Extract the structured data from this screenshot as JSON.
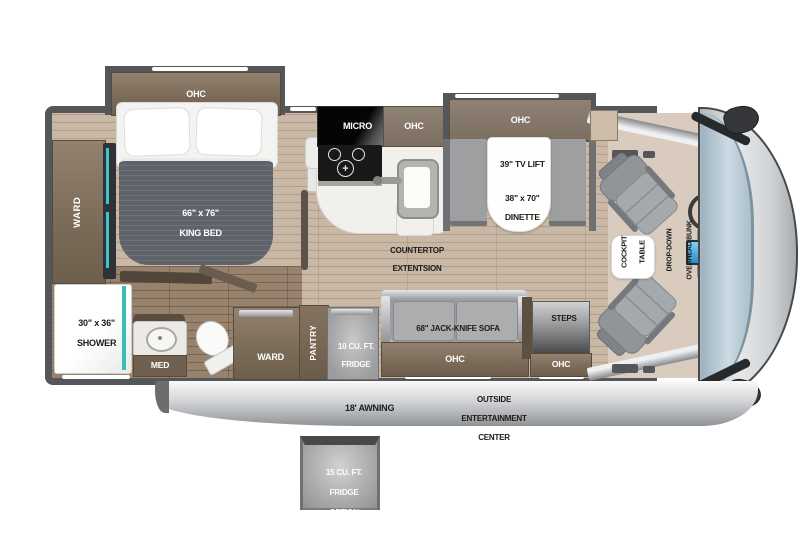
{
  "labels": {
    "bedroom_ohc": "OHC",
    "king_bed_size": "66\" x 76\"",
    "king_bed_name": "KING BED",
    "ward_bedroom": "WARD",
    "tv_option": "TV OPTION",
    "shower_size": "30\" x 36\"",
    "shower_name": "SHOWER",
    "med": "MED",
    "micro": "MICRO",
    "kitchen_ohc": "OHC",
    "countertop_l1": "COUNTERTOP",
    "countertop_l2": "EXTENTSION",
    "dinette_ohc": "OHC",
    "tv_lift": "39\" TV LIFT",
    "dinette_size": "38\" x 70\"",
    "dinette_name": "DINETTE",
    "sofa": "68\" JACK-KNIFE SOFA",
    "sofa_ohc": "OHC",
    "steps": "STEPS",
    "entry_ohc": "OHC",
    "ward_hall": "WARD",
    "pantry": "PANTRY",
    "fridge_l1": "10 CU. FT.",
    "fridge_l2": "FRIDGE",
    "cockpit_table_l1": "COCKPIT",
    "cockpit_table_l2": "TABLE",
    "bunk_l1": "DROP-DOWN",
    "bunk_l2": "OVERHEAD BUNK",
    "bunk_l3": "OPTION",
    "awning": "18' AWNING",
    "outside_l1": "OUTSIDE",
    "outside_l2": "ENTERTAINMENT",
    "outside_l3": "CENTER",
    "fridge_option_l1": "15 CU. FT.",
    "fridge_option_l2": "FRIDGE",
    "fridge_option_l3": "OPTION"
  },
  "colors": {
    "wall": "#55565a",
    "cabinet_brown": "#7a6a58",
    "floor_light": "#c8b8a5",
    "floor_dark": "#97826d",
    "accent_teal": "#3bbcba",
    "windshield_blue": "#a9bfcc",
    "bed_gray": "#5e6269",
    "awning_gray": "#c9cbcd"
  }
}
